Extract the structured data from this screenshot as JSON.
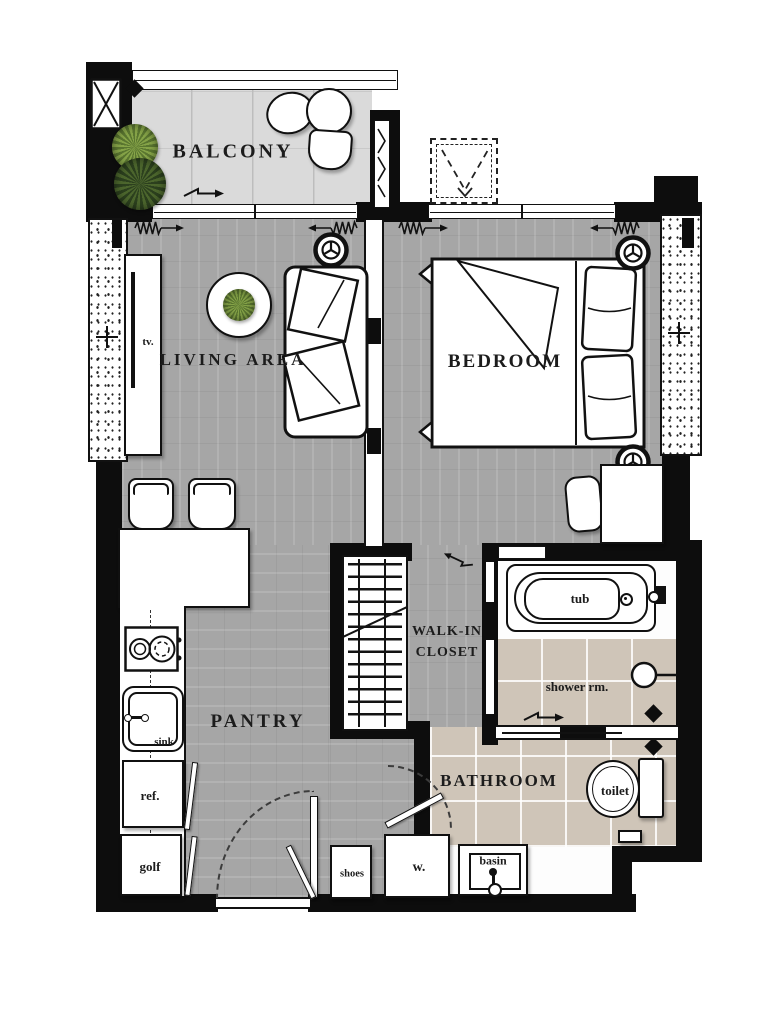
{
  "colors": {
    "wall": "#0d0d0d",
    "wood_floor": "#a6a6a6",
    "balcony_floor": "#dadada",
    "bathroom_tile": "#cfc5b8",
    "plant_light": "#86a448",
    "plant_dark": "#3f5a28",
    "label_ink": "#1c1c1c"
  },
  "rooms": {
    "balcony": {
      "label": "BALCONY"
    },
    "living_area": {
      "label": "LIVING AREA",
      "tv_label": "tv."
    },
    "bedroom": {
      "label": "BEDROOM"
    },
    "walk_in_closet": {
      "label_line1": "WALK-IN",
      "label_line2": "CLOSET"
    },
    "pantry": {
      "label": "PANTRY",
      "sink_label": "sink",
      "fridge_label": "ref.",
      "golf_label": "golf"
    },
    "bathroom": {
      "label": "BATHROOM",
      "shower_label": "shower rm.",
      "tub_label": "tub",
      "toilet_label": "toilet",
      "basin_label": "basin"
    },
    "entry": {
      "shoes_label": "shoes",
      "washer_label": "w."
    }
  }
}
